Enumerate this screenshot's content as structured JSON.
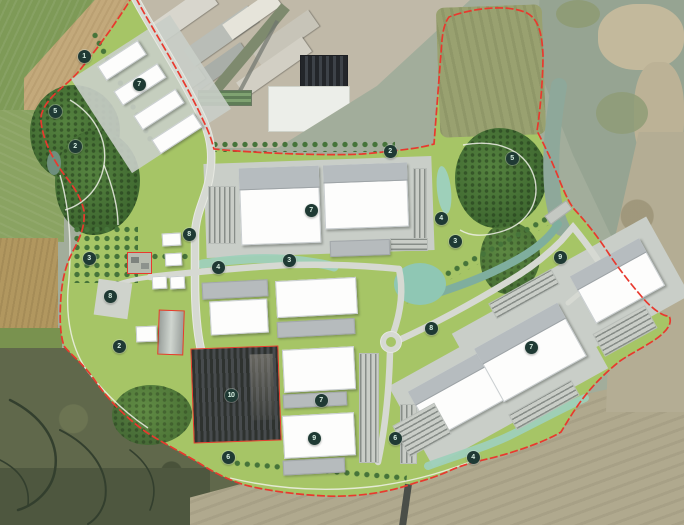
{
  "plan": {
    "markers": [
      {
        "n": "1",
        "x": 84,
        "y": 56
      },
      {
        "n": "7",
        "x": 139,
        "y": 84
      },
      {
        "n": "5",
        "x": 55,
        "y": 111
      },
      {
        "n": "2",
        "x": 75,
        "y": 146
      },
      {
        "n": "2",
        "x": 390,
        "y": 151
      },
      {
        "n": "5",
        "x": 512,
        "y": 158
      },
      {
        "n": "7",
        "x": 311,
        "y": 210
      },
      {
        "n": "4",
        "x": 441,
        "y": 218
      },
      {
        "n": "8",
        "x": 189,
        "y": 234
      },
      {
        "n": "3",
        "x": 455,
        "y": 241
      },
      {
        "n": "3",
        "x": 89,
        "y": 258
      },
      {
        "n": "3",
        "x": 289,
        "y": 260
      },
      {
        "n": "9",
        "x": 560,
        "y": 257
      },
      {
        "n": "4",
        "x": 218,
        "y": 267
      },
      {
        "n": "8",
        "x": 110,
        "y": 296
      },
      {
        "n": "8",
        "x": 431,
        "y": 328
      },
      {
        "n": "2",
        "x": 119,
        "y": 346
      },
      {
        "n": "7",
        "x": 531,
        "y": 347
      },
      {
        "n": "10",
        "x": 231,
        "y": 395
      },
      {
        "n": "7",
        "x": 321,
        "y": 400
      },
      {
        "n": "9",
        "x": 314,
        "y": 438
      },
      {
        "n": "6",
        "x": 395,
        "y": 438
      },
      {
        "n": "6",
        "x": 228,
        "y": 457
      },
      {
        "n": "4",
        "x": 473,
        "y": 457
      }
    ]
  },
  "palette": {
    "boundary_red": "#e8392e",
    "marker_bg": "#1f3a34",
    "marker_fg": "#d8efe2",
    "plan_green": "#a6c566",
    "road_grey": "#d6d9d2",
    "water_teal": "#8fc7b4"
  }
}
